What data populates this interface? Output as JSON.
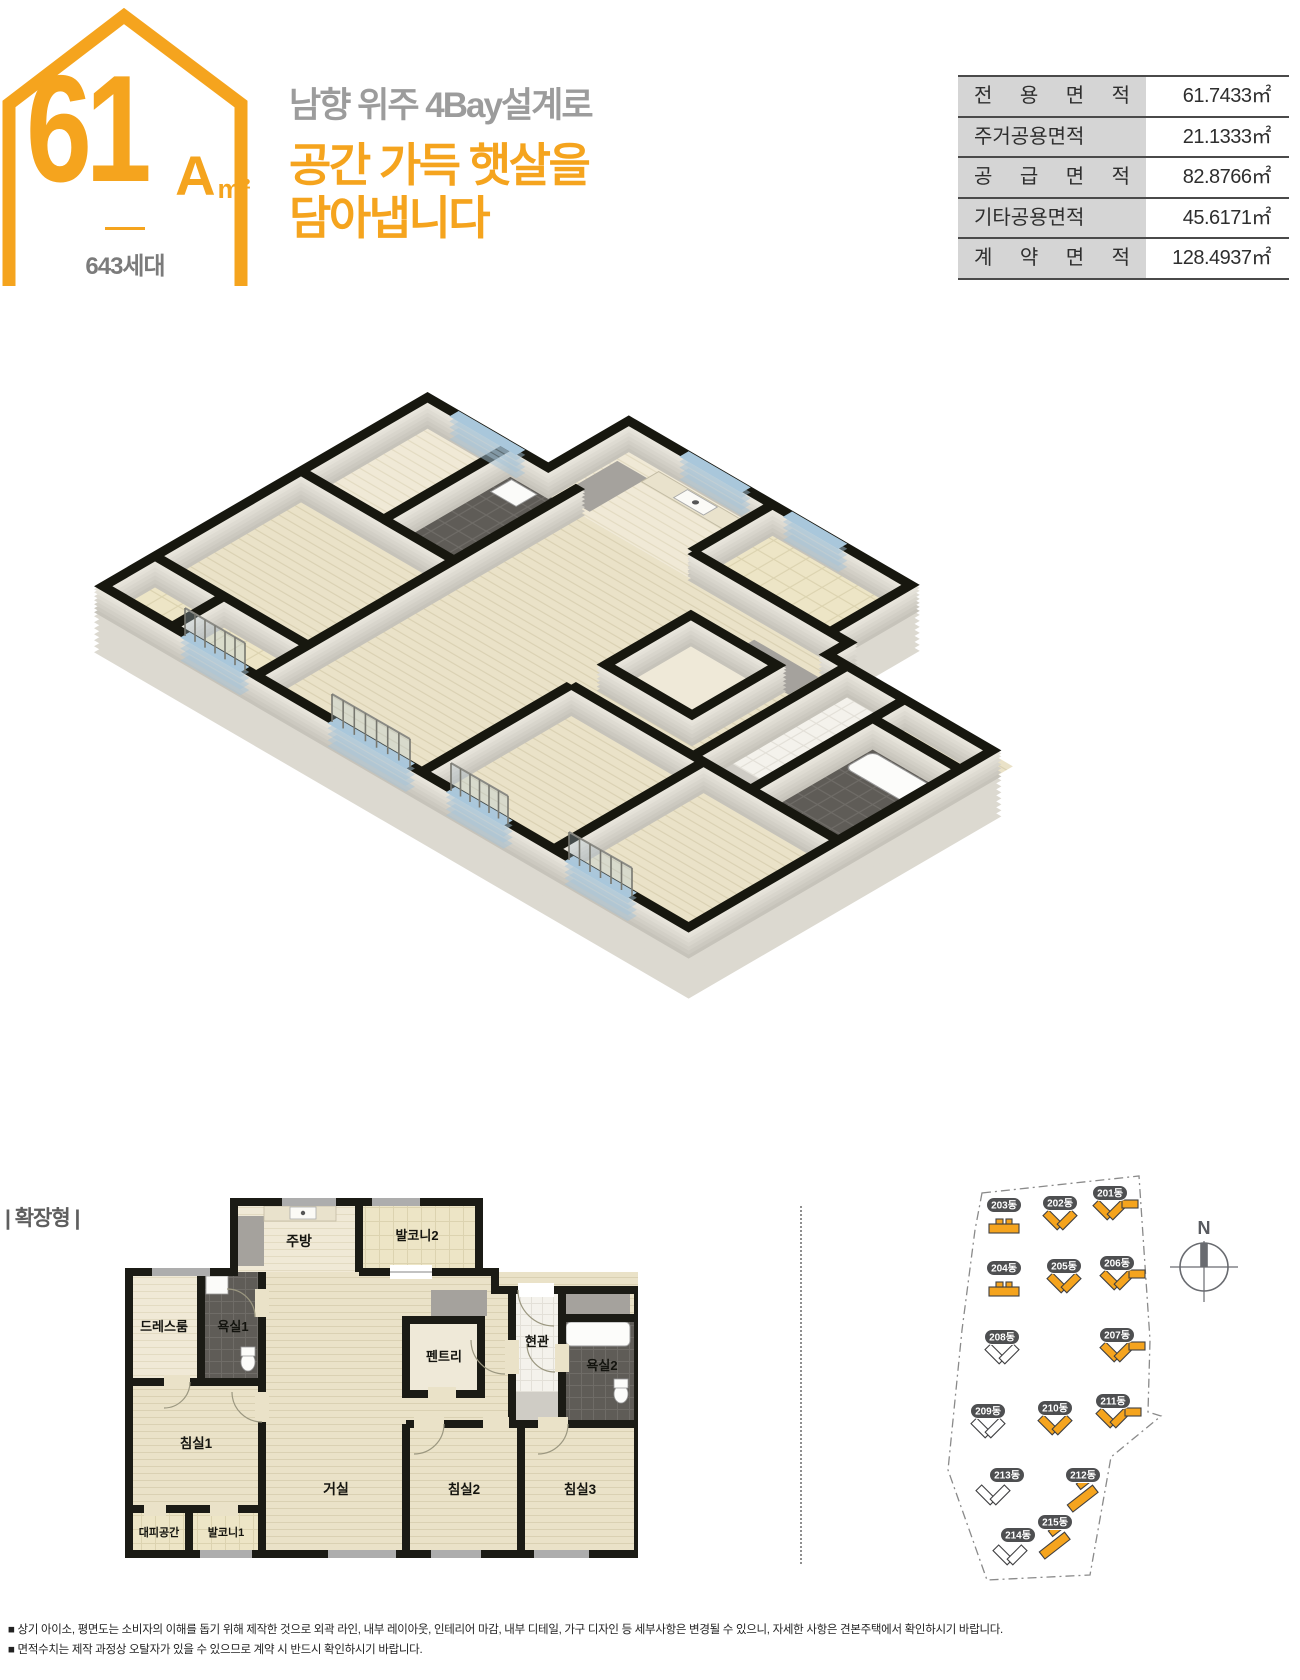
{
  "unit_badge": {
    "size": "61",
    "variant": "A",
    "unit": "m²",
    "households": "643세대"
  },
  "headline": {
    "line1": "남향 위주 4Bay설계로",
    "line2": "공간 가득 햇살을",
    "line3": "담아냅니다"
  },
  "area_table": {
    "rows": [
      {
        "label": "전 용 면 적",
        "value": "61.7433㎡"
      },
      {
        "label": "주거공용면적",
        "value": "21.1333㎡"
      },
      {
        "label": "공 급 면 적",
        "value": "82.8766㎡"
      },
      {
        "label": "기타공용면적",
        "value": "45.6171㎡"
      },
      {
        "label": "계 약 면 적",
        "value": "128.4937㎡"
      }
    ]
  },
  "section": {
    "label": "| 확장형 |"
  },
  "floorplan2d": {
    "rooms": [
      {
        "label": "주방",
        "x": 185,
        "y": 52,
        "size": 14
      },
      {
        "label": "발코니2",
        "x": 303,
        "y": 46,
        "size": 13
      },
      {
        "label": "드레스룸",
        "x": 50,
        "y": 137,
        "size": 13
      },
      {
        "label": "욕실1",
        "x": 119,
        "y": 137,
        "size": 13
      },
      {
        "label": "펜트리",
        "x": 330,
        "y": 167,
        "size": 13
      },
      {
        "label": "현관",
        "x": 423,
        "y": 152,
        "size": 13
      },
      {
        "label": "욕실2",
        "x": 488,
        "y": 176,
        "size": 13
      },
      {
        "label": "침실1",
        "x": 82,
        "y": 254,
        "size": 13.5
      },
      {
        "label": "거실",
        "x": 222,
        "y": 300,
        "size": 14
      },
      {
        "label": "침실2",
        "x": 350,
        "y": 300,
        "size": 13.5
      },
      {
        "label": "침실3",
        "x": 466,
        "y": 300,
        "size": 13.5
      },
      {
        "label": "대피공간",
        "x": 45,
        "y": 342,
        "size": 11
      },
      {
        "label": "발코니1",
        "x": 112,
        "y": 342,
        "size": 11
      }
    ]
  },
  "sitemap": {
    "compass_label": "N",
    "buildings": [
      {
        "name": "203동",
        "x": 139,
        "y": 85,
        "glyph": "bar",
        "filled": true
      },
      {
        "name": "202동",
        "x": 195,
        "y": 83,
        "glyph": "v",
        "filled": true
      },
      {
        "name": "201동",
        "x": 245,
        "y": 73,
        "glyph": "vbar",
        "filled": true
      },
      {
        "name": "204동",
        "x": 139,
        "y": 148,
        "glyph": "bar",
        "filled": true
      },
      {
        "name": "205동",
        "x": 199,
        "y": 146,
        "glyph": "v",
        "filled": true
      },
      {
        "name": "206동",
        "x": 252,
        "y": 143,
        "glyph": "vbar",
        "filled": true
      },
      {
        "name": "208동",
        "x": 137,
        "y": 217,
        "glyph": "v",
        "filled": false
      },
      {
        "name": "207동",
        "x": 252,
        "y": 215,
        "glyph": "vbar",
        "filled": true
      },
      {
        "name": "209동",
        "x": 123,
        "y": 291,
        "glyph": "v",
        "filled": false
      },
      {
        "name": "210동",
        "x": 190,
        "y": 288,
        "glyph": "v",
        "filled": true
      },
      {
        "name": "211동",
        "x": 248,
        "y": 281,
        "glyph": "vbar",
        "filled": true
      },
      {
        "name": "213동",
        "x": 142,
        "y": 355,
        "glyph": "v",
        "filled": false,
        "gdx": -14,
        "gdy": 27
      },
      {
        "name": "212동",
        "x": 218,
        "y": 355,
        "glyph": "diag",
        "filled": true
      },
      {
        "name": "215동",
        "x": 190,
        "y": 402,
        "glyph": "diag",
        "filled": true
      },
      {
        "name": "214동",
        "x": 153,
        "y": 415,
        "glyph": "v",
        "filled": false,
        "gdx": -8,
        "gdy": 27
      }
    ]
  },
  "disclaimer": {
    "lines": [
      "■ 상기 아이소, 평면도는 소비자의 이해를 돕기 위해 제작한 것으로 외곽 라인, 내부 레이아웃, 인테리어 마감, 내부 디테일, 가구 디자인 등 세부사항은 변경될 수 있으니, 자세한 사항은 견본주택에서 확인하시기 바랍니다.",
      "■ 면적수치는 제작 과정상 오탈자가 있을 수 있으므로 계약 시 반드시 확인하시기 바랍니다."
    ]
  },
  "colors": {
    "accent_orange": "#F5A41E",
    "headline_gray": "#9C9C9C",
    "wall_black": "#1B1B15",
    "floor_beige": "#EAE2C8",
    "bath_tile": "#5F5C57",
    "badge_gray": "#4E4F51",
    "table_label_bg": "#D5D5D5"
  }
}
